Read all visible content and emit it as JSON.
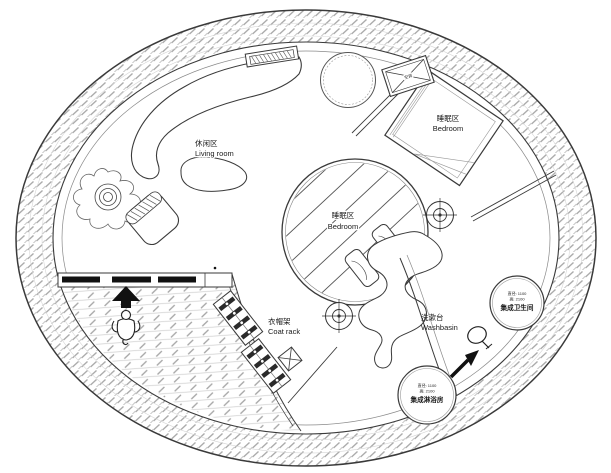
{
  "labels": {
    "living_room": {
      "zh": "休闲区",
      "en": "Living room"
    },
    "bedroom_upper": {
      "zh": "睡眠区",
      "en": "Bedroom"
    },
    "bedroom_center": {
      "zh": "睡眠区",
      "en": "Bedroom"
    },
    "coat_rack": {
      "zh": "衣帽架",
      "en": "Coat rack"
    },
    "washbasin": {
      "zh": "洗漱台",
      "en": "Washbasin"
    },
    "toilet_pod": {
      "dim_diameter": "直径: 1100",
      "dim_height": "高: 2100",
      "name": "集成卫生间"
    },
    "shower_pod": {
      "dim_diameter": "直径: 1100",
      "dim_height": "高: 2100",
      "name": "集成淋浴房"
    },
    "ac_unit": {
      "label": "空调"
    }
  },
  "colors": {
    "line": "#3a3a3a",
    "hatch": "#a8a8a8",
    "paper": "#ffffff",
    "solid": "#111111"
  }
}
